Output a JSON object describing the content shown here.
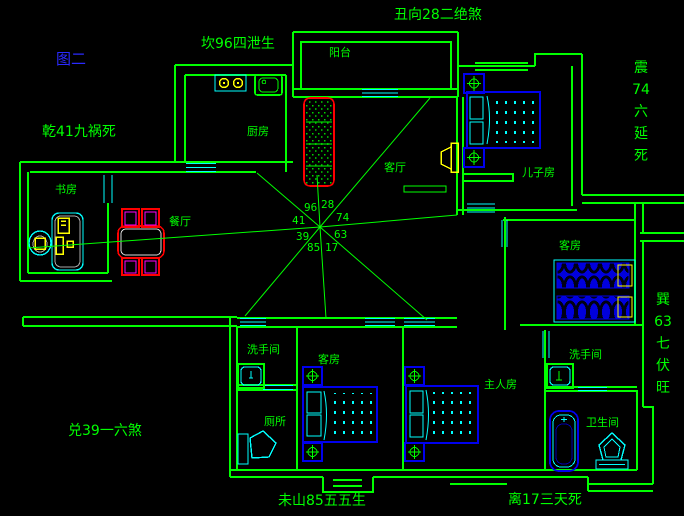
{
  "title": {
    "text": "图二"
  },
  "annotations": {
    "kan": "坎96四泄生",
    "chou": "丑向28二绝煞",
    "qian": "乾41九祸死",
    "dui": "兑39一六煞",
    "wei": "未山85五五生",
    "li": "离17三天死",
    "zhen": "震\n74\n六\n延\n死",
    "xun": "巽\n63\n七\n伏\n旺"
  },
  "compass": {
    "nw": "96",
    "ne": "28",
    "w": "41",
    "e": "74",
    "sw": "39",
    "se": "63",
    "ssw": "85",
    "sse": "17"
  },
  "rooms": {
    "study": "书房",
    "dining": "餐厅",
    "kitchen": "厨房",
    "balcony": "阳台",
    "living": "客厅",
    "son": "儿子房",
    "guest_right": "客房",
    "washroom_left": "洗手间",
    "toilet": "厕所",
    "guest_bottom": "客房",
    "master": "主人房",
    "washroom_right": "洗手间",
    "bathroom": "卫生间"
  },
  "colors": {
    "wall": "#00ff00",
    "window": "#00ffff",
    "bed": "#0000ee",
    "red": "#ff0000",
    "yellow": "#ffff00",
    "magenta": "#ff00ff",
    "title": "#2a2aff",
    "text": "#00ff00",
    "bg": "#000000",
    "gray": "#a8a8a8"
  }
}
